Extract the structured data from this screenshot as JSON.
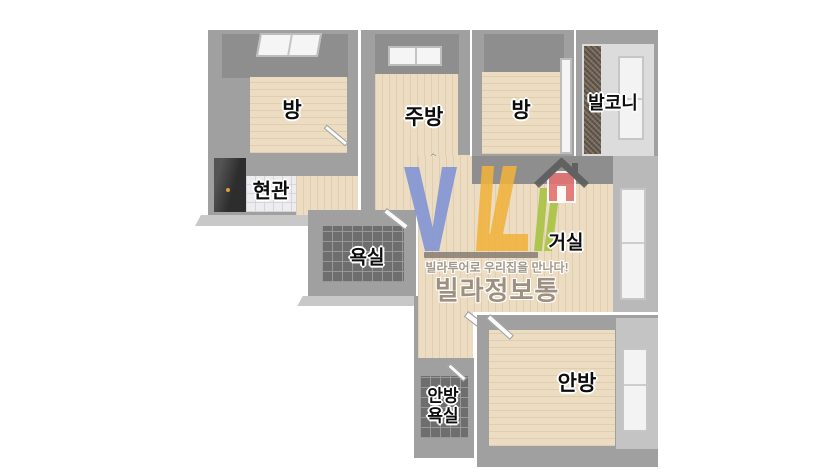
{
  "page": {
    "background": "#ffffff"
  },
  "floorplan": {
    "rooms": {
      "room1": {
        "label": "방"
      },
      "kitchen": {
        "label": "주방"
      },
      "room2": {
        "label": "방"
      },
      "balcony": {
        "label": "발코니"
      },
      "entrance": {
        "label": "현관"
      },
      "bathroom": {
        "label": "욕실"
      },
      "living": {
        "label": "거실"
      },
      "master_bedroom": {
        "label": "안방"
      },
      "master_bathroom": {
        "label_line1": "안방",
        "label_line2": "욕실"
      }
    }
  },
  "watermark": {
    "slogan": "빌라투어로 우리집을 만나다!",
    "brand": "빌라정보통",
    "icons": {
      "house": "house-icon"
    },
    "logo_colors": {
      "blue": "#8093d6",
      "yellow": "#f1b23c",
      "green": "#a6c441",
      "house_red": "#e57272",
      "roof_gray": "#5b5b5b",
      "bar": "#8a8077",
      "slogan_text": "#a2988a",
      "brand_text": "#9d9080"
    }
  },
  "palette": {
    "wall": "#a0a0a0",
    "wall_dark": "#8e8e8e",
    "wall_light": "#b9b9b9",
    "wall_edge": "#c8c8c8",
    "floor_wood": "#ecdcc1",
    "tile_dark": "#6e6e6e",
    "tile_dark_grout": "#989898",
    "tile_white": "#ededef",
    "tile_white_grout": "#d5d5da",
    "balcony_floor": "#7a6c5e",
    "door_dark": "#3c3c3c",
    "handle_gold": "#d9a13a"
  }
}
